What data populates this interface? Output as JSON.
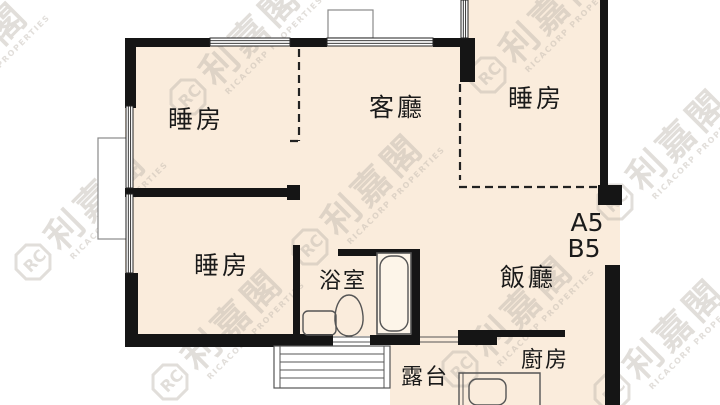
{
  "rooms": {
    "bedroom_top_left": {
      "label": "睡房"
    },
    "living_room": {
      "label": "客廳"
    },
    "bedroom_top_right": {
      "label": "睡房"
    },
    "bedroom_mid_left": {
      "label": "睡房"
    },
    "bathroom": {
      "label": "浴室"
    },
    "dining_room": {
      "label": "飯廳"
    },
    "balcony": {
      "label": "露台"
    },
    "kitchen": {
      "label": "廚房"
    }
  },
  "units": {
    "a5": "A5",
    "b5": "B5"
  },
  "watermark": {
    "monogram": "RC",
    "brand_cjk": "利嘉閣",
    "brand_en": "RICACORP PROPERTIES"
  },
  "colors": {
    "background": "#ffffff",
    "room_fill": "#faecdc",
    "wall": "#151515",
    "outline_gray": "#8a8a8a",
    "fixture_line": "#555555",
    "watermark_gray": "#b9b1a8",
    "label_text": "#1a1a1a"
  }
}
